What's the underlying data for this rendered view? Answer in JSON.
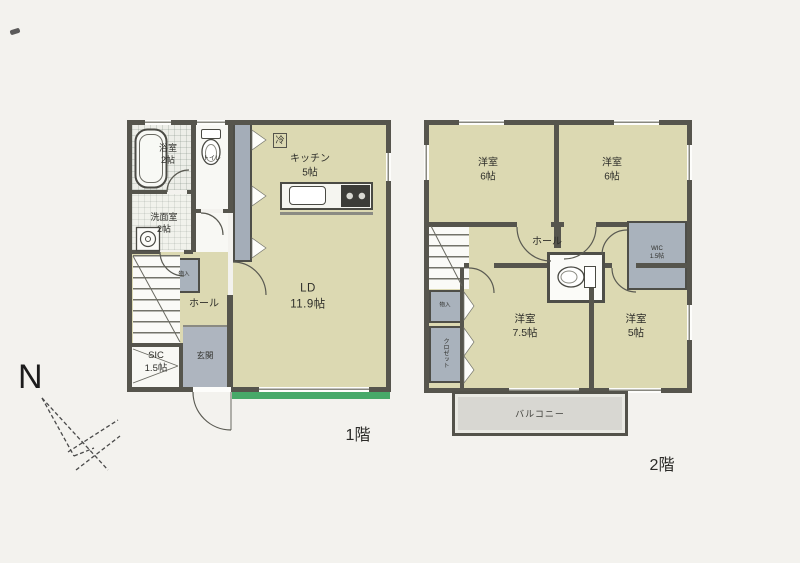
{
  "captions": {
    "floor1": "1階",
    "floor2": "2階"
  },
  "compass": {
    "label": "N"
  },
  "floor1": {
    "bath": {
      "name": "浴室",
      "size": "2帖"
    },
    "washroom": {
      "name": "洗面室",
      "size": "2帖"
    },
    "toilet": {
      "name": "トイレ"
    },
    "fridge": {
      "label": "冷"
    },
    "kitchen": {
      "name": "キッチン",
      "size": "5帖"
    },
    "living": {
      "name": "LD",
      "size": "11.9帖"
    },
    "hall": {
      "name": "ホール"
    },
    "storage": {
      "name": "物入"
    },
    "shoe_closet": {
      "name": "SIC",
      "size": "1.5帖"
    },
    "entrance": {
      "name": "玄関"
    }
  },
  "floor2": {
    "bedroom_nw": {
      "name": "洋室",
      "size": "6帖"
    },
    "bedroom_ne": {
      "name": "洋室",
      "size": "6帖"
    },
    "hall": {
      "name": "ホール"
    },
    "wic": {
      "name": "WIC",
      "size": "1.5帖"
    },
    "storage": {
      "name": "物入"
    },
    "closet": {
      "name": "クロゼット"
    },
    "bedroom_sw": {
      "name": "洋室",
      "size": "7.5帖"
    },
    "bedroom_se": {
      "name": "洋室",
      "size": "5帖"
    },
    "balcony": {
      "name": "バルコニー"
    }
  },
  "colors": {
    "wall": "#56554d",
    "room_floor": "#dcd9b2",
    "gray_area": "#a9b2bc",
    "balcony": "#d8d7d2",
    "garden_green": "#47a969"
  }
}
